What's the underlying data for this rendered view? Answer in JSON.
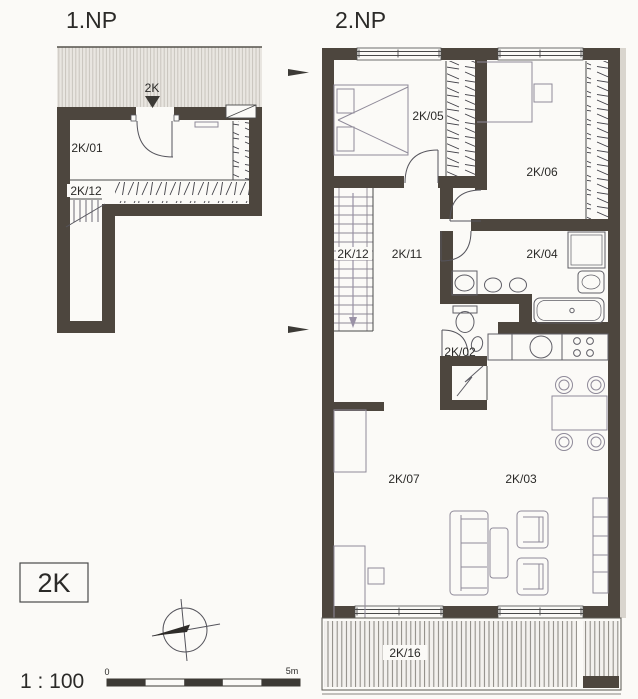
{
  "document": {
    "type": "architectural floor plan",
    "floor1": {
      "title": "1.NP",
      "entrance_marker": "2K",
      "rooms": [
        {
          "id": "2K/01"
        },
        {
          "id": "2K/12"
        }
      ]
    },
    "floor2": {
      "title": "2.NP",
      "rooms": [
        {
          "id": "2K/05"
        },
        {
          "id": "2K/06"
        },
        {
          "id": "2K/12"
        },
        {
          "id": "2K/11"
        },
        {
          "id": "2K/04"
        },
        {
          "id": "2K/02"
        },
        {
          "id": "2K/07"
        },
        {
          "id": "2K/03"
        },
        {
          "id": "2K/16"
        }
      ]
    },
    "legend": {
      "unit_label": "2K",
      "scale_text": "1 : 100",
      "scale_bar": {
        "start_label": "0",
        "end_label": "5m"
      }
    },
    "colors": {
      "wall": "#4d463e",
      "paper": "#fbfaf7",
      "furniture_line": "#8f8a99",
      "fixture_line": "#5f5e66"
    }
  }
}
